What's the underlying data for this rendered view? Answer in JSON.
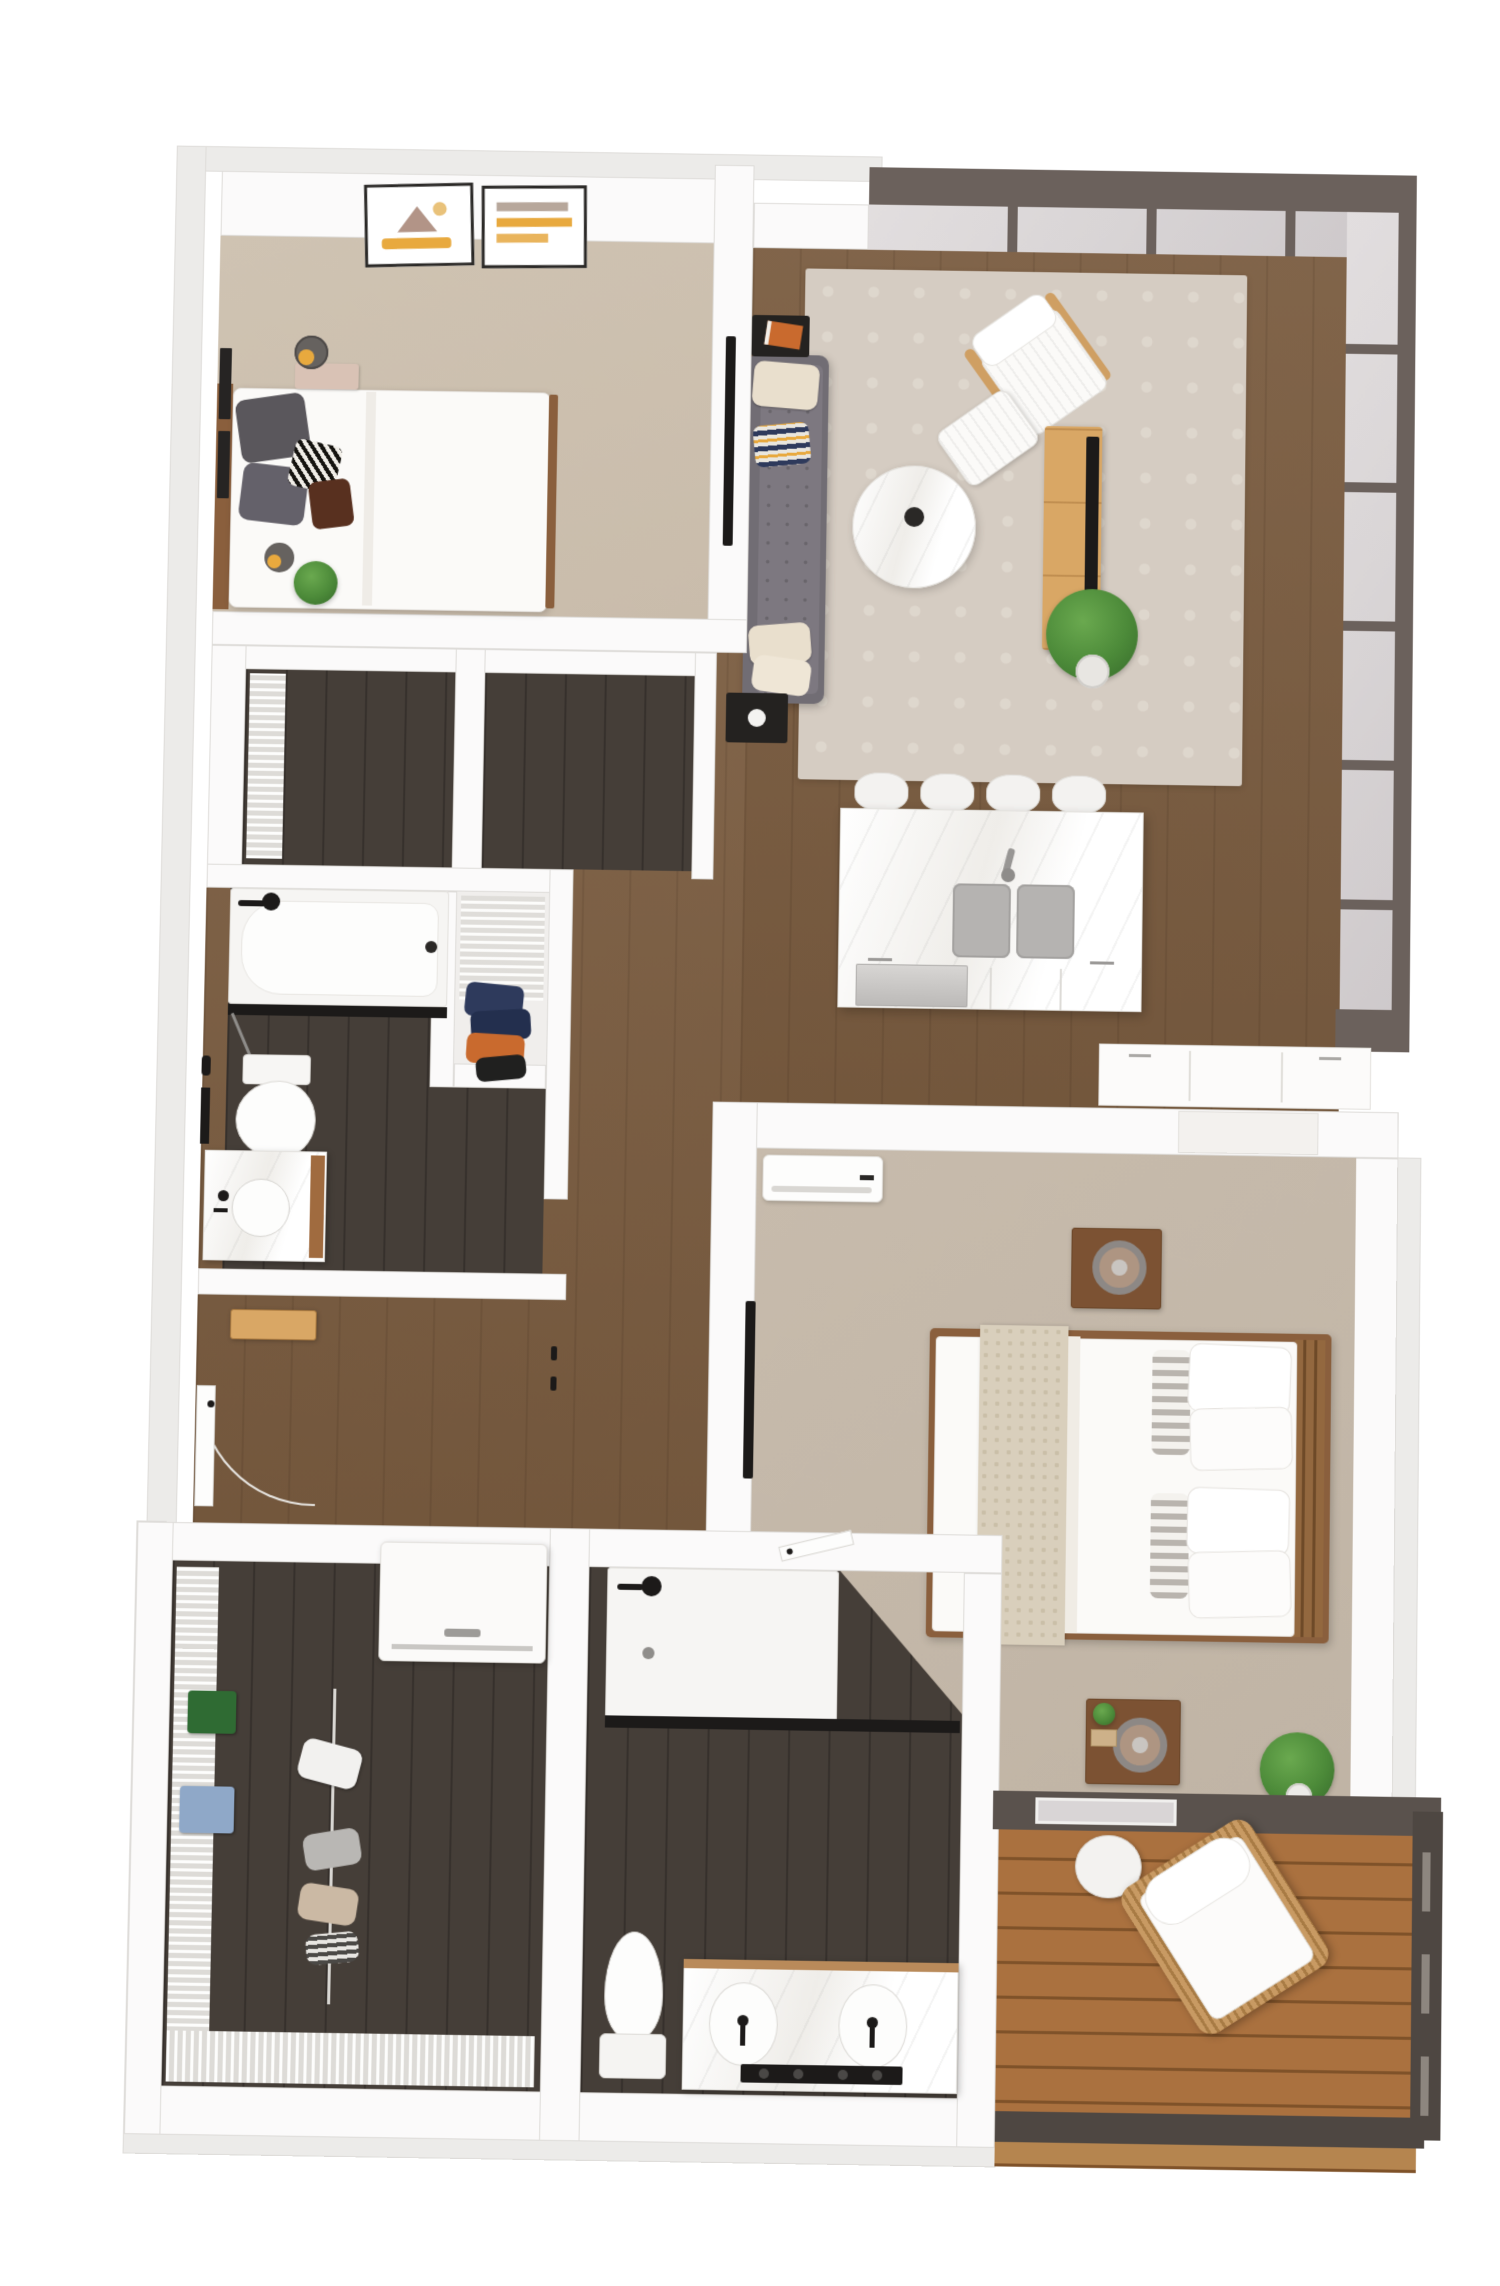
{
  "meta": {
    "type": "3d-floor-plan-render",
    "description": "Top-down 3D architectural rendering of a two-bedroom, two-bathroom apartment with open living/kitchen area, window wall, walk-in closet with laundry, and private balcony",
    "visible_text": ""
  },
  "palette": {
    "exterior": "#ecebe9",
    "wallEdge": "#dedcd9",
    "wallFace": "#fbfafa",
    "wood": "#7a5c40",
    "darkFloor": "#453e38",
    "carpetBedroom2": "#c9bcab",
    "carpetMaster": "#c0b4a5",
    "deck": "#aa713f",
    "deckGap": "#7f5229",
    "frame": "#6b615c",
    "glass": "#d9d5d6",
    "rug": "#d5ccc2",
    "rugMotif": "#ded7cd",
    "sofa": "#716d74",
    "sofaSeat": "#7d7880",
    "cream": "#e9dfcd",
    "marbleVein": "#efede9",
    "sinkGray": "#b5b3b1",
    "steel": "#ceccca",
    "bedFrameWood": "#8a5f3d",
    "consoleWood": "#d9a765",
    "nightstandWood": "#7c5233",
    "plant": "#4c8a39",
    "plantDark": "#35692a",
    "accentYellow": "#e8a93e",
    "accentOrange": "#c96a2e",
    "navy": "#2e3a5c",
    "black": "#1c1a19"
  },
  "rooms": [
    {
      "id": "bedroom-2",
      "name": "bedroom"
    },
    {
      "id": "living-room",
      "name": "living room"
    },
    {
      "id": "kitchen",
      "name": "kitchen"
    },
    {
      "id": "hallway",
      "name": "hallway and entry"
    },
    {
      "id": "bathroom-2",
      "name": "guest bathroom"
    },
    {
      "id": "hall-closets",
      "name": "hall closets"
    },
    {
      "id": "linen-closet",
      "name": "linen closet"
    },
    {
      "id": "walk-in-closet",
      "name": "walk-in closet with laundry"
    },
    {
      "id": "primary-bathroom",
      "name": "primary bathroom"
    },
    {
      "id": "primary-bedroom",
      "name": "primary bedroom"
    },
    {
      "id": "balcony",
      "name": "balcony"
    }
  ],
  "furniture": {
    "bedroom-2": [
      "queen bed",
      "wall art frames",
      "table lamps",
      "leaning picture frames",
      "plant",
      "wall tv"
    ],
    "living-room": [
      "tufted gray sofa",
      "throw pillows",
      "black side tables",
      "round marble coffee table",
      "white lounge chair",
      "ottoman",
      "area rug",
      "media console",
      "tv",
      "potted plant",
      "window wall"
    ],
    "kitchen": [
      "island with double sink",
      "faucet",
      "dishwasher",
      "bar stools",
      "wall counter cabinets"
    ],
    "bathroom-2": [
      "tub shower with glass",
      "toilet",
      "single vanity with round sink",
      "black fixtures"
    ],
    "walk-in-closet": [
      "wire shelving",
      "folded clothes",
      "hanging clothes",
      "washer dryer"
    ],
    "primary-bathroom": [
      "walk-in shower",
      "glass panel",
      "toilet",
      "double vanity with two sinks",
      "black faucets"
    ],
    "primary-bedroom": [
      "king bed",
      "nightstands",
      "ring lamps",
      "ac unit",
      "wall tv",
      "plants",
      "balcony door"
    ],
    "balcony": [
      "rattan lounge chair",
      "round side table",
      "railing",
      "wood deck"
    ]
  }
}
